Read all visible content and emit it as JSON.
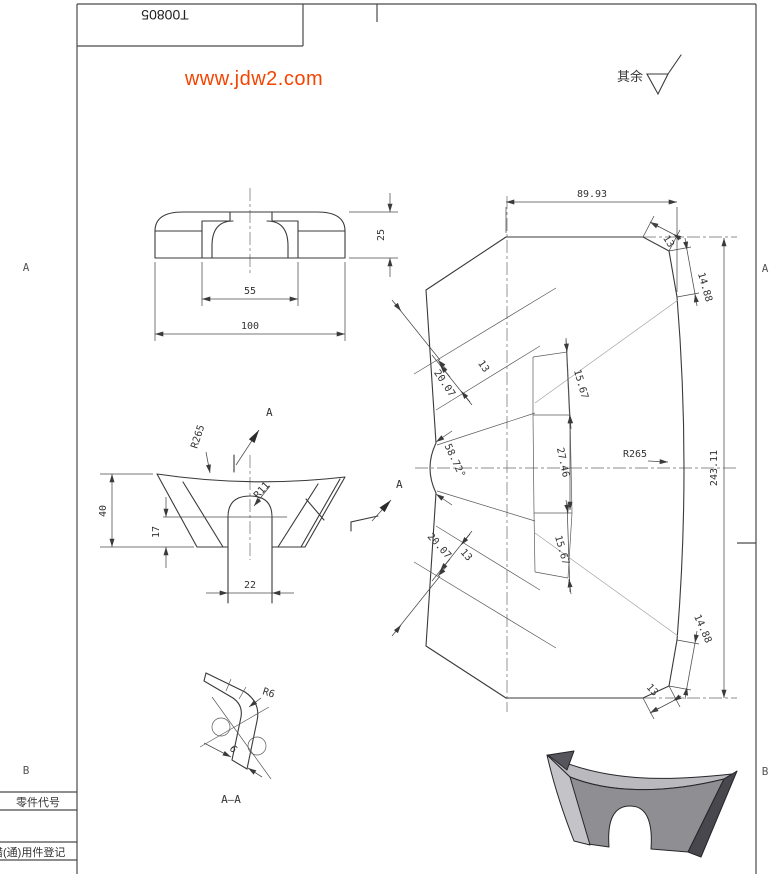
{
  "sheet": {
    "part_number": "T00805",
    "watermark": "www.jdw2.com",
    "surface_note_label": "其余",
    "zone_labels": {
      "left_a": "A",
      "right_a": "A",
      "left_b": "B",
      "right_b": "B"
    },
    "title_table": {
      "row_part_code": "零件代号",
      "row_common_parts": "借(通)用件登记"
    },
    "colors": {
      "line": "#3a3a3a",
      "watermark": "#f44400",
      "part_light": "#c4c4c8",
      "part_mid": "#8e8e93",
      "part_dark": "#47474d",
      "background": "#ffffff"
    }
  },
  "views": {
    "front": {
      "dims": {
        "depth": "25",
        "slot_width": "55",
        "overall_width": "100"
      }
    },
    "side": {
      "section_arrow_label": "A",
      "dims": {
        "height": "40",
        "slot_center_height": "17",
        "slot_width": "22",
        "top_radius": "R265",
        "slot_radius": "R11"
      }
    },
    "development": {
      "dims": {
        "half_width_top": "89.93",
        "top_bend_1": "13",
        "top_bend_2": "14.88",
        "band_outer_top": "20.07",
        "band_inner_top": "13",
        "flange_top": "15.67",
        "center_band": "27.46",
        "notch_angle": "58.72°",
        "face_radius": "R265",
        "overall_length": "243.11",
        "flange_bottom": "15.67",
        "band_outer_bottom": "20.07",
        "band_inner_bottom": "13",
        "bottom_bend_2": "14.88",
        "bottom_bend_1": "13"
      }
    },
    "section": {
      "label": "A—A",
      "dims": {
        "bend_radius": "R6",
        "thickness": "6"
      }
    }
  }
}
